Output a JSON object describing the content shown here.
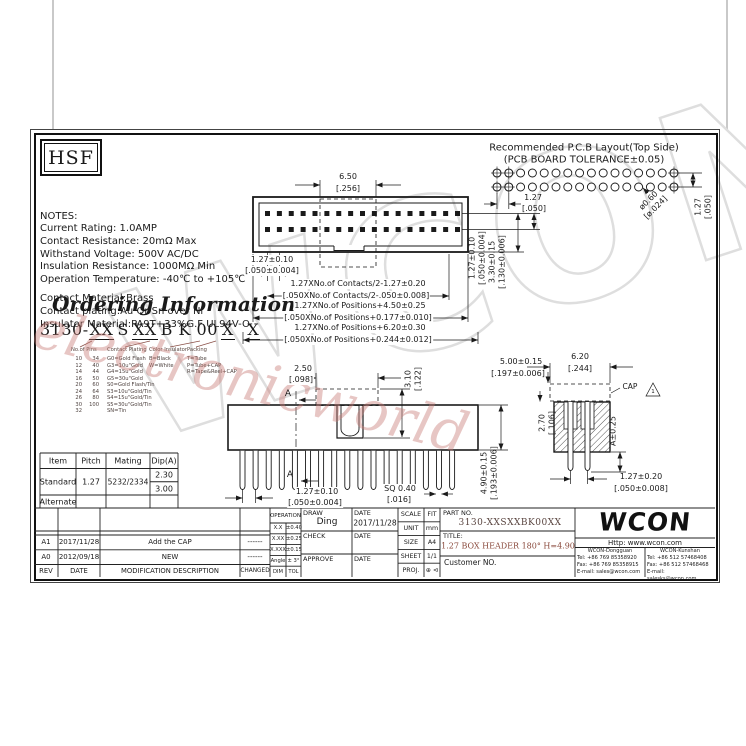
{
  "logo_hsf": "HSF",
  "notes": {
    "lines": [
      "NOTES:",
      "Current Rating: 1.0AMP",
      "Contact Resistance: 20mΩ Max",
      "Withstand Voltage: 500V AC/DC",
      "Insulation Resistance: 1000MΩ Min",
      "Operation Temperature: -40℃ to +105℃",
      "",
      "Contact Material:Brass",
      "Contact plating:Au Or Sn over Ni",
      "Insulator Material:PA9T+33%G.F UL94V-O"
    ]
  },
  "ordering": {
    "title": "Ordering Information",
    "code": {
      "prefix": "3130-",
      "pins": "XX",
      "mid1": "S",
      "plating": "XX",
      "mid2": "B K 00",
      "color": "X",
      "packing": "X"
    },
    "col_pins_label": "No.of Pins",
    "col_plating_label": "Contact Plating",
    "col_color_label": "Color Insulator",
    "col_packing_label": "Packing",
    "pins_col1": [
      "10",
      "12",
      "14",
      "16",
      "20",
      "24",
      "26",
      "30",
      "32"
    ],
    "pins_col2": [
      "34",
      "40",
      "44",
      "50",
      "60",
      "64",
      "80",
      "100"
    ],
    "plating": [
      "G0=Gold Flash",
      "G3=10u\"Gold",
      "G4=15u\"Gold",
      "G5=30u\"Gold",
      "S0=Gold Flash/Tin",
      "S3=10u\"Gold/Tin",
      "S4=15u\"Gold/Tin",
      "S5=30u\"Gold/Tin",
      "SN=Tin"
    ],
    "colors": [
      "B=Black",
      "W=White"
    ],
    "packing": [
      "T=Tube",
      "P=Tube+CAP",
      "R=Tape&Reel+CAP"
    ]
  },
  "pcb": {
    "title1": "Recommended P.C.B Layout(Top Side)",
    "title2": "(PCB BOARD TOLERANCE±0.05)",
    "pitch_mm": "1.27",
    "pitch_in": "[.050]",
    "hole_mm": "ø0.60",
    "hole_in": "[ø.024]",
    "row_mm": "1.27",
    "row_in": "[.050]"
  },
  "top_view": {
    "cap_w_mm": "6.50",
    "cap_w_in": "[.256]",
    "pitch_mm": "1.27±0.10",
    "pitch_in": "[.050±0.004]",
    "chainA_mm": "1.27XNo.of Contacts/2-1.27±0.20",
    "chainA_in": "[.050XNo.of Contacts/2-.050±0.008]",
    "chainB_mm": "1.27XNo.of Positions+4.50±0.25",
    "chainB_in": "[.050XNo.of Positions+0.177±0.010]",
    "chainC_mm": "1.27XNo.of Positions+6.20±0.30",
    "chainC_in": "[.050XNo.of Positions+0.244±0.012]",
    "row_mm": "1.27±0.10",
    "row_in": "[.050±0.004]",
    "h_mm": "3.30±0.15",
    "h_in": "[.130±0.006]"
  },
  "front_view": {
    "key_w_mm": "2.50",
    "key_w_in": "[.098]",
    "key_h_mm": "3.10",
    "key_h_in": "[.122]",
    "section": "A",
    "pitch_mm": "1.27±0.10",
    "pitch_in": "[.050±0.004]",
    "sq_mm": "SQ 0.40",
    "sq_in": "[.016]",
    "h_mm": "4.90±0.15",
    "h_in": "[.193±0.006]"
  },
  "section_view": {
    "w_mm": "6.20",
    "w_in": "[.244]",
    "cap_h_mm": "5.00±0.15",
    "cap_h_in": "[.197±0.006]",
    "cap_label": "CAP",
    "tri": "1",
    "depth_mm": "2.70",
    "depth_in": "[.106]",
    "tail": "A±0.25",
    "pitch_mm": "1.27±0.20",
    "pitch_in": "[.050±0.008]"
  },
  "item_table": {
    "headers": [
      "Item",
      "Pitch",
      "Mating",
      "Dip(A)"
    ],
    "standard": {
      "item": "Standard",
      "pitch": "1.27",
      "mating": "5232/2334",
      "dip1": "2.30",
      "dip2": "3.00"
    },
    "alternate": "Alternate"
  },
  "rev_table": {
    "rows": [
      {
        "rev": "A1",
        "date": "2017/11/28",
        "desc": "Add the CAP",
        "chg": "------"
      },
      {
        "rev": "A0",
        "date": "2012/09/18",
        "desc": "NEW",
        "chg": "------"
      }
    ],
    "header": {
      "rev": "REV",
      "date": "DATE",
      "desc": "MODIFICATION  DESCRIPTION",
      "chg": "CHANGED"
    }
  },
  "tol_block": {
    "title": "OPERATION",
    "rows": [
      {
        "a": "X.X",
        "b": "±0.40"
      },
      {
        "a": "X.XX",
        "b": "±0.25"
      },
      {
        "a": "X.XXX",
        "b": "±0.15"
      },
      {
        "a": "Angle",
        "b": "± 3°"
      },
      {
        "a": "DIM",
        "b": "TOL"
      }
    ]
  },
  "sign_block": {
    "draw_label": "DRAW",
    "draw_name": "Ding",
    "date_label": "DATE",
    "draw_date": "2017/11/28",
    "check_label": "CHECK",
    "approve_label": "APPROVE"
  },
  "scale_block": {
    "rows": [
      {
        "k": "SCALE",
        "v": "FIT"
      },
      {
        "k": "UNIT",
        "v": "mm"
      },
      {
        "k": "SIZE",
        "v": "A4"
      },
      {
        "k": "SHEET",
        "v": "1/1"
      },
      {
        "k": "PROJ.",
        "v": "⊕ ⊲"
      }
    ]
  },
  "part_block": {
    "part_label": "PART NO.",
    "part_no": "3130-XXSXXBK00XX",
    "title_label": "TITLE:",
    "title": "1.27 BOX HEADER 180° H=4.90",
    "customer": "Customer NO."
  },
  "company": {
    "logo": "WCON",
    "url": "Http: www.wcon.com",
    "branches": [
      {
        "name": "WCON-Dongguan",
        "tel": "Tel: +86 769 85358920",
        "fax": "Fax: +86 769 85358915",
        "mail": "E-mail: sales@wcon.com"
      },
      {
        "name": "WCON-Kunshan",
        "tel": "Tel: +86 512 57468408",
        "fax": "Fax: +86 512 57468468",
        "mail": "E-mail: salesks@wcon.com"
      }
    ]
  },
  "watermarks": {
    "gray": "WCON",
    "red": "electronicworld",
    "gray_color": "#dedede",
    "red_color": "#c87a74"
  },
  "colors": {
    "accent_red": "#8a4a3c",
    "line": "#1a1a1a"
  },
  "drawing": {
    "top_pins_per_row": 17,
    "front_pins": 17,
    "pcb_cols": 16,
    "pcb_rows": 2
  }
}
